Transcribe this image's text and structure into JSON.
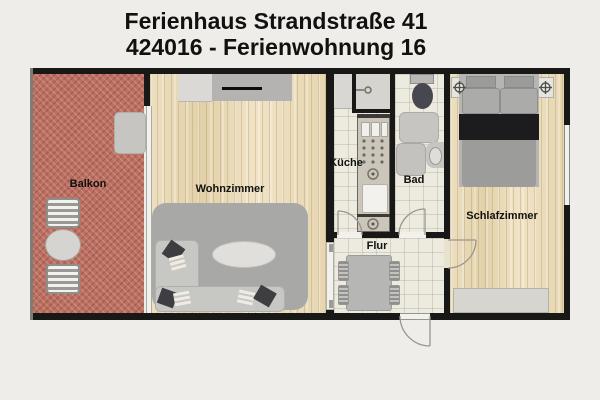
{
  "title": {
    "line1": "Ferienhaus Strandstraße 41",
    "line2": "424016 - Ferienwohnung 16"
  },
  "rooms": {
    "balkon": {
      "label": "Balkon"
    },
    "wohnzimmer": {
      "label": "Wohnzimmer"
    },
    "kueche": {
      "label": "Küche"
    },
    "bad": {
      "label": "Bad"
    },
    "flur": {
      "label": "Flur"
    },
    "schlafzimmer": {
      "label": "Schlafzimmer"
    }
  },
  "legend": {
    "balkon": [
      "two slatted chairs",
      "round table",
      "doormat"
    ],
    "wohnzimmer": [
      "tv sideboard",
      "rug",
      "l-shaped sofa with pillows",
      "oval coffee table"
    ],
    "kueche": [
      "counter with stove, sink and hotplates",
      "small storage niche"
    ],
    "bad": [
      "toilet",
      "shower mat",
      "washer",
      "wall sink"
    ],
    "flur": [
      "dining table with four chairs",
      "entrance door"
    ],
    "schlafzimmer": [
      "double bed",
      "two nightstands with lamps",
      "wardrobe",
      "window"
    ]
  },
  "colors": {
    "background": "#efede9",
    "wall": "#181816",
    "wood_floor": "#e8dab8",
    "tile_floor": "#edeadf",
    "balcony_floor": "#bd7061",
    "rug": "#a8a8a6",
    "sofa": "#c7c7c3",
    "dark_pillow": "#3e3e42",
    "bed_duvet": "#9c9c9a",
    "black_accent": "#1c1c1e",
    "furniture_gray": "#c6c5c1",
    "glass": "#f2f1ec",
    "label": "#111110"
  }
}
